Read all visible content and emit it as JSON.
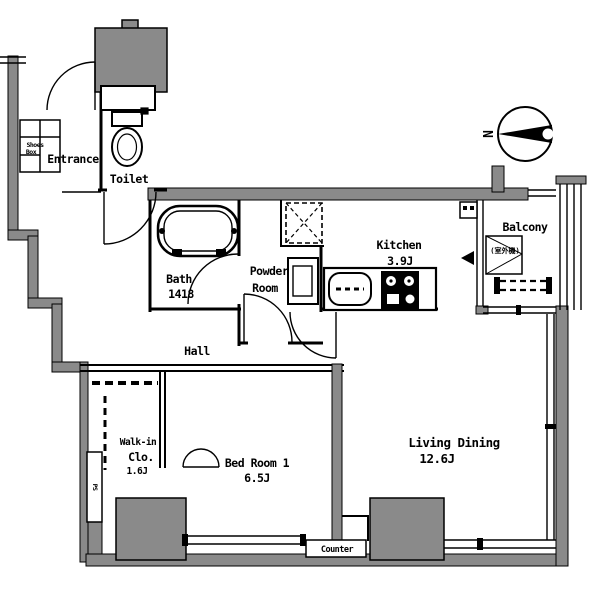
{
  "plan": {
    "rooms": {
      "entrance": {
        "label": "Entrance"
      },
      "shoes_box": {
        "line1": "Shoes",
        "line2": "Box"
      },
      "toilet": {
        "label": "Toilet"
      },
      "bath": {
        "label": "Bath",
        "size": "1418"
      },
      "powder_room": {
        "line1": "Powder",
        "line2": "Room"
      },
      "kitchen": {
        "label": "Kitchen",
        "size": "3.9J"
      },
      "balcony": {
        "label": "Balcony",
        "annotation": "(室外機)"
      },
      "hall": {
        "label": "Hall"
      },
      "walk_in_closet": {
        "line1": "Walk-in",
        "line2": "Clo.",
        "size": "1.6J"
      },
      "bedroom": {
        "label": "Bed Room 1",
        "size": "6.5J"
      },
      "living_dining": {
        "label": "Living Dining",
        "size": "12.6J"
      },
      "pipe_space": {
        "label": "PS"
      }
    },
    "counter": {
      "label": "Counter"
    },
    "compass": {
      "label": "N"
    },
    "colors": {
      "wall_gray": "#8a8a8a",
      "line_black": "#000000",
      "background": "#ffffff"
    }
  }
}
